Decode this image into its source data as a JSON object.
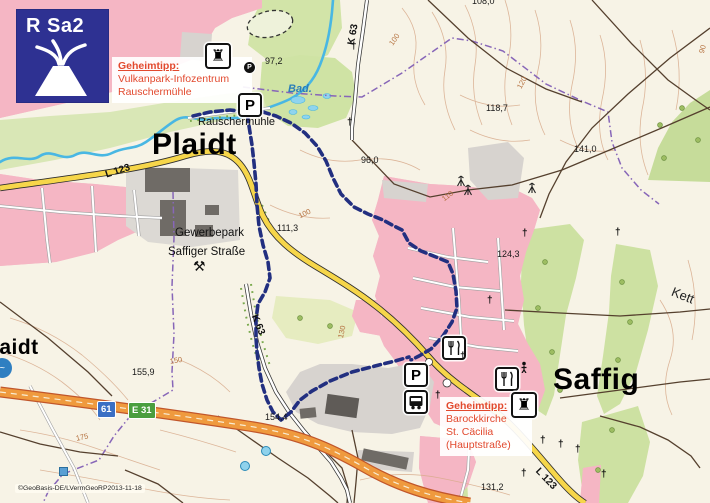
{
  "map": {
    "badge": {
      "code": "R Sa2",
      "color": "#2e3192",
      "icon": "volcano-icon"
    },
    "tips": [
      {
        "title": "Geheimtipp:",
        "lines": [
          "Vulkanpark-Infozentrum",
          "Rauschermühle"
        ]
      },
      {
        "title": "Geheimtipp:",
        "lines": [
          "Barockkirche",
          "St. Cäcilia",
          "(Hauptstraße)"
        ]
      }
    ],
    "towns": [
      {
        "name": "Plaidt",
        "x": 152,
        "y": 128,
        "size": 30
      },
      {
        "name": "Saffig",
        "x": 553,
        "y": 363,
        "size": 30
      },
      {
        "name": "laidt",
        "x": -7,
        "y": 336,
        "size": 21
      }
    ],
    "labels": [
      {
        "text": "97,2",
        "x": 265,
        "y": 56,
        "cls": "elev"
      },
      {
        "text": "108,0",
        "x": 472,
        "y": -4,
        "cls": "elev"
      },
      {
        "text": "96,0",
        "x": 361,
        "y": 155,
        "cls": "elev"
      },
      {
        "text": "118,7",
        "x": 486,
        "y": 103,
        "cls": "elev"
      },
      {
        "text": "141,0",
        "x": 574,
        "y": 144,
        "cls": "elev"
      },
      {
        "text": "111,3",
        "x": 277,
        "y": 223,
        "cls": "elev"
      },
      {
        "text": "124,3",
        "x": 497,
        "y": 249,
        "cls": "elev"
      },
      {
        "text": "155,9",
        "x": 132,
        "y": 367,
        "cls": "elev"
      },
      {
        "text": "154,4",
        "x": 265,
        "y": 412,
        "cls": "elev"
      },
      {
        "text": "131,2",
        "x": 481,
        "y": 482,
        "cls": "elev"
      },
      {
        "text": "K 63",
        "x": 346,
        "y": 44,
        "cls": "road",
        "rot": -80
      },
      {
        "text": "L 123",
        "x": 104,
        "y": 170,
        "cls": "road",
        "rot": -18
      },
      {
        "text": "K 63",
        "x": 259,
        "y": 313,
        "cls": "road",
        "rot": 68
      },
      {
        "text": "L 123",
        "x": 541,
        "y": 466,
        "cls": "road",
        "rot": 46
      },
      {
        "text": "Rauschermühle",
        "x": 198,
        "y": 116,
        "cls": "place11"
      },
      {
        "text": "Bad.",
        "x": 288,
        "y": 83,
        "cls": "water"
      },
      {
        "text": "Gewerbepark",
        "x": 175,
        "y": 227,
        "cls": "place12"
      },
      {
        "text": "Saffiger Straße",
        "x": 168,
        "y": 246,
        "cls": "place12"
      },
      {
        "text": "Kett",
        "x": 675,
        "y": 284,
        "cls": "place13",
        "rot": 22
      },
      {
        "text": "100",
        "x": 387,
        "y": 42,
        "cls": "contour",
        "rot": -55
      },
      {
        "text": "120",
        "x": 515,
        "y": 86,
        "cls": "contour",
        "rot": -62
      },
      {
        "text": "110",
        "x": 440,
        "y": 196,
        "cls": "contour",
        "rot": -38
      },
      {
        "text": "100",
        "x": 297,
        "y": 212,
        "cls": "contour",
        "rot": -25
      },
      {
        "text": "130",
        "x": 336,
        "y": 337,
        "cls": "contour",
        "rot": -78
      },
      {
        "text": "150",
        "x": 169,
        "y": 357,
        "cls": "contour",
        "rot": -10
      },
      {
        "text": "175",
        "x": 75,
        "y": 434,
        "cls": "contour",
        "rot": -12
      },
      {
        "text": "90",
        "x": 697,
        "y": 52,
        "cls": "contour",
        "rot": -75
      }
    ],
    "road_badges": [
      {
        "label": "61",
        "x": 97,
        "y": 401,
        "type": "blue",
        "color": "#3a6fc4"
      },
      {
        "label": "E 31",
        "x": 128,
        "y": 402,
        "type": "green",
        "color": "#4a9e3f"
      }
    ],
    "icons": [
      {
        "kind": "tower",
        "name": "tower-museum-icon",
        "x": 205,
        "y": 43,
        "size": 26,
        "glyph": "♜"
      },
      {
        "kind": "parking",
        "name": "parking-icon",
        "x": 238,
        "y": 93,
        "size": 24,
        "glyph": "P"
      },
      {
        "kind": "pdot",
        "name": "parking-dot-icon",
        "x": 243,
        "y": 61,
        "glyph": "P"
      },
      {
        "kind": "parking",
        "name": "parking-icon",
        "x": 404,
        "y": 363,
        "size": 24,
        "glyph": "P"
      },
      {
        "kind": "bus",
        "name": "bus-stop-icon",
        "x": 404,
        "y": 390,
        "size": 24
      },
      {
        "kind": "restaurant",
        "name": "restaurant-icon",
        "x": 442,
        "y": 336,
        "size": 24
      },
      {
        "kind": "restaurant",
        "name": "restaurant-icon",
        "x": 495,
        "y": 367,
        "size": 24
      },
      {
        "kind": "tower",
        "name": "tower-museum-icon",
        "x": 511,
        "y": 392,
        "size": 26,
        "glyph": "♜"
      },
      {
        "kind": "hammers",
        "name": "mine-hammers-icon",
        "x": 193,
        "y": 258,
        "glyph": "⚒"
      },
      {
        "kind": "mast",
        "name": "radio-mast-icon",
        "x": 455,
        "y": 174
      },
      {
        "kind": "mast",
        "name": "radio-mast-icon",
        "x": 462,
        "y": 183
      },
      {
        "kind": "mast",
        "name": "radio-mast-icon",
        "x": 526,
        "y": 181
      },
      {
        "kind": "figure",
        "name": "statue-icon",
        "x": 519,
        "y": 360
      },
      {
        "kind": "cross",
        "name": "wayside-cross-icon",
        "x": 351,
        "y": 41,
        "glyph": "†"
      },
      {
        "kind": "cross",
        "name": "wayside-cross-icon",
        "x": 347,
        "y": 117,
        "glyph": "†"
      },
      {
        "kind": "cross",
        "name": "wayside-cross-icon",
        "x": 615,
        "y": 227,
        "glyph": "†"
      },
      {
        "kind": "cross",
        "name": "wayside-cross-icon",
        "x": 522,
        "y": 228,
        "glyph": "†"
      },
      {
        "kind": "cross",
        "name": "wayside-cross-icon",
        "x": 487,
        "y": 295,
        "glyph": "†"
      },
      {
        "kind": "cross",
        "name": "wayside-cross-icon",
        "x": 460,
        "y": 351,
        "glyph": "†"
      },
      {
        "kind": "cross",
        "name": "wayside-cross-icon",
        "x": 435,
        "y": 390,
        "glyph": "†"
      },
      {
        "kind": "cross",
        "name": "wayside-cross-icon",
        "x": 540,
        "y": 435,
        "glyph": "†"
      },
      {
        "kind": "cross",
        "name": "wayside-cross-icon",
        "x": 558,
        "y": 439,
        "glyph": "†"
      },
      {
        "kind": "cross",
        "name": "wayside-cross-icon",
        "x": 575,
        "y": 444,
        "glyph": "†"
      },
      {
        "kind": "cross",
        "name": "wayside-cross-icon",
        "x": 521,
        "y": 468,
        "glyph": "†"
      },
      {
        "kind": "cross",
        "name": "wayside-cross-icon",
        "x": 601,
        "y": 469,
        "glyph": "†"
      },
      {
        "kind": "spring",
        "name": "spring-icon",
        "x": 261,
        "y": 446
      },
      {
        "kind": "spring",
        "name": "spring-icon",
        "x": 240,
        "y": 461
      },
      {
        "kind": "bluedot",
        "name": "poi-blue-icon",
        "x": -8,
        "y": 358
      },
      {
        "kind": "bluesq",
        "name": "poi-blue-square-icon",
        "x": 59,
        "y": 467
      }
    ],
    "route": {
      "color": "#222f80",
      "legs": [
        [
          [
            193,
            116
          ],
          [
            210,
            112
          ],
          [
            230,
            110
          ],
          [
            247,
            112
          ],
          [
            249,
            126
          ],
          [
            252,
            145
          ],
          [
            254,
            163
          ],
          [
            256,
            184
          ],
          [
            257,
            205
          ],
          [
            259,
            226
          ],
          [
            263,
            245
          ],
          [
            268,
            262
          ],
          [
            270,
            278
          ],
          [
            265,
            292
          ],
          [
            258,
            304
          ],
          [
            256,
            320
          ],
          [
            256,
            338
          ],
          [
            257,
            352
          ],
          [
            259,
            368
          ],
          [
            262,
            384
          ],
          [
            267,
            400
          ],
          [
            273,
            412
          ],
          [
            281,
            420
          ],
          [
            291,
            412
          ],
          [
            300,
            400
          ],
          [
            312,
            391
          ],
          [
            330,
            381
          ],
          [
            352,
            372
          ],
          [
            375,
            366
          ],
          [
            395,
            361
          ],
          [
            409,
            357
          ]
        ],
        [
          [
            251,
            112
          ],
          [
            263,
            112
          ],
          [
            276,
            116
          ],
          [
            291,
            123
          ],
          [
            305,
            133
          ],
          [
            317,
            146
          ],
          [
            326,
            161
          ],
          [
            333,
            178
          ],
          [
            341,
            194
          ],
          [
            354,
            207
          ],
          [
            368,
            214
          ],
          [
            383,
            220
          ],
          [
            394,
            226
          ],
          [
            402,
            230
          ],
          [
            409,
            243
          ],
          [
            421,
            251
          ],
          [
            436,
            257
          ],
          [
            448,
            262
          ],
          [
            453,
            274
          ],
          [
            456,
            291
          ],
          [
            457,
            308
          ],
          [
            452,
            322
          ],
          [
            443,
            336
          ],
          [
            431,
            349
          ],
          [
            419,
            356
          ],
          [
            411,
            360
          ]
        ]
      ]
    },
    "copyright": "©GeoBasis-DE/LVermGeoRP2013-11-18",
    "colors": {
      "urban": "#f4b6c4",
      "forest": "#cde1a2",
      "water": "#49b7e3",
      "road_yellow": "#f6d64a",
      "motorway": "#ef9a3e",
      "boundary": "#8766b8",
      "route": "#222f80",
      "tip_red": "#e2492e",
      "badge_blue": "#2e3192"
    }
  }
}
